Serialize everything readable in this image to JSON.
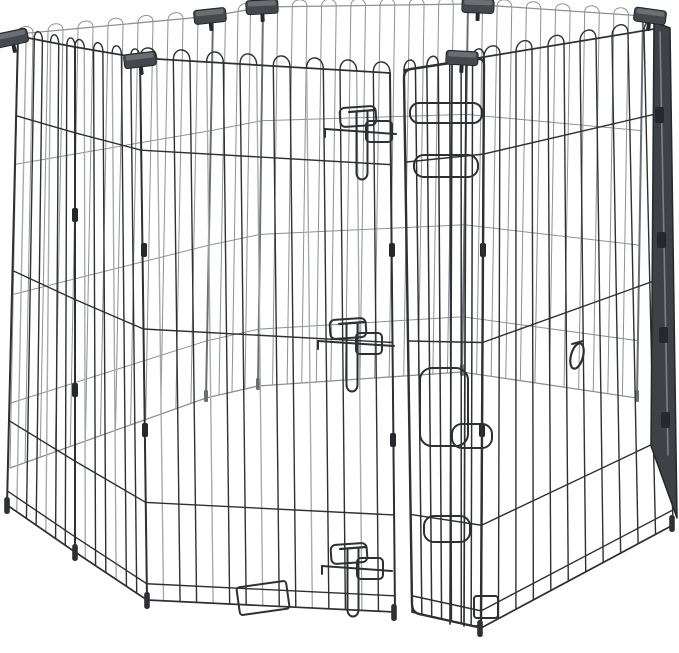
{
  "scene": {
    "type": "product-photo",
    "description": "Black 8-panel foldable metal wire pet exercise pen with arched loop tops, black plastic corner clips, and a front step-through door held by three sliding wire bolt latches, photographed on a plain white background",
    "subject": "foldable metal wire pet exercise pen",
    "panel_count_visible": 8,
    "background": "plain white studio background",
    "parts": {
      "panel": "wire mesh panel with arched loop top",
      "corner_clip": "black plastic corner clip",
      "door": "step-through door panel, slightly ajar",
      "latch": "sliding wire bolt latch with T-handle",
      "hinge_loop": "wire hinge and keeper loop",
      "snap_hook": "metal snap hook",
      "anchor_loop": "ground anchor wire loop",
      "folded_edge": "edge-on folded side panel"
    }
  },
  "colors": {
    "background": "#ffffff",
    "wire_dark": "#2e3033",
    "wire_mid": "#595c5f",
    "wire_light": "#a8abad",
    "wire_back": "#8e9193",
    "post_back": "#6c6f72",
    "clip_fill": "#45494e",
    "clip_hi": "#6a6f74",
    "clip_dark": "#26282b",
    "band_fill": "#3e4246",
    "band_hi": "#7b7f83"
  }
}
